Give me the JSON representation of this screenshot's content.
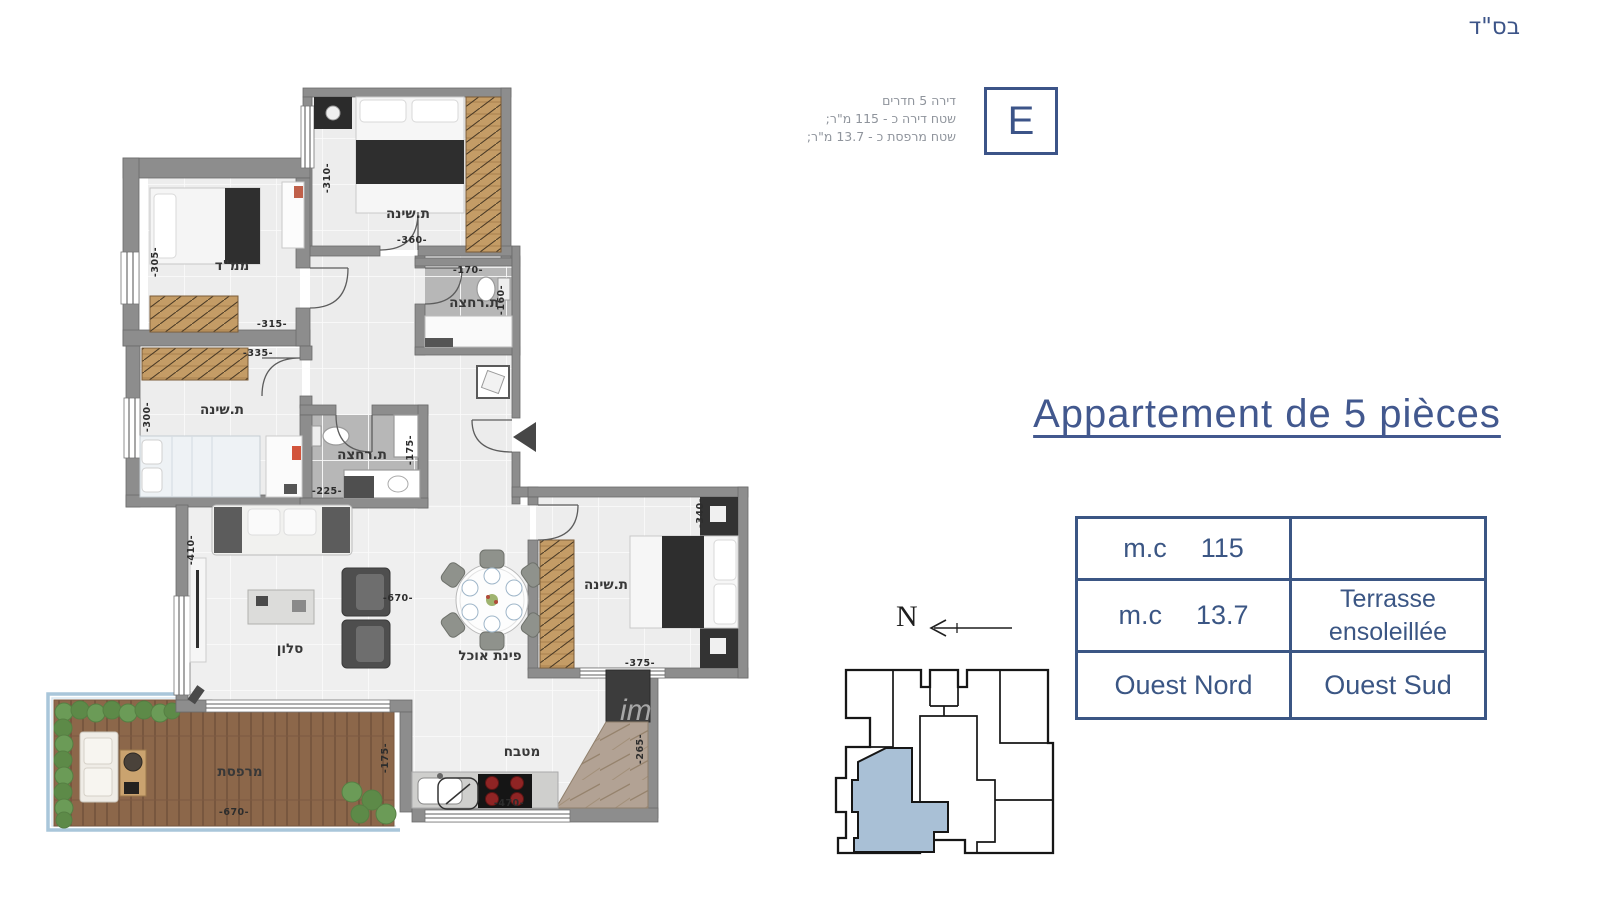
{
  "header": {
    "bsd": "בס\"ד"
  },
  "unit_info": {
    "letter": "E",
    "line1": "דירה 5 חדרים",
    "line2": "שטח דירה כ - 115 מ\"ר;",
    "line3": "שטח מרפסת כ - 13.7 מ\"ר;"
  },
  "title": "Appartement de 5 pièces",
  "spec_table": {
    "rows": [
      {
        "label": "m.c",
        "value": "115",
        "right": ""
      },
      {
        "label": "m.c",
        "value": "13.7",
        "right": "Terrasse\nensoleillée"
      },
      {
        "label": "",
        "value": "Ouest Nord",
        "right": "Ouest Sud"
      }
    ]
  },
  "compass": {
    "label": "N"
  },
  "watermark": "im",
  "colors": {
    "accent_blue": "#3c5488",
    "keyplan_unit_fill": "#a9c0d6"
  },
  "floor_plan": {
    "rooms": [
      {
        "label": "ת.שינה",
        "x": 408,
        "y": 218
      },
      {
        "label": "ממ\"ד",
        "x": 232,
        "y": 270
      },
      {
        "label": "ת.רחצה",
        "x": 474,
        "y": 307
      },
      {
        "label": "ת.שינה",
        "x": 222,
        "y": 414
      },
      {
        "label": "ת.רחצה",
        "x": 362,
        "y": 459
      },
      {
        "label": "סלון",
        "x": 290,
        "y": 653
      },
      {
        "label": "פינת אוכל",
        "x": 490,
        "y": 660
      },
      {
        "label": "ת.שינה",
        "x": 606,
        "y": 589
      },
      {
        "label": "מטבח",
        "x": 522,
        "y": 756
      },
      {
        "label": "מרפסת",
        "x": 240,
        "y": 776
      }
    ],
    "dims": [
      {
        "text": "-310-",
        "x": 330,
        "y": 178,
        "vertical": true
      },
      {
        "text": "-360-",
        "x": 412,
        "y": 243,
        "vertical": false
      },
      {
        "text": "-305-",
        "x": 158,
        "y": 262,
        "vertical": true
      },
      {
        "text": "-315-",
        "x": 272,
        "y": 327,
        "vertical": false
      },
      {
        "text": "-335-",
        "x": 258,
        "y": 356,
        "vertical": false
      },
      {
        "text": "-300-",
        "x": 150,
        "y": 417,
        "vertical": true
      },
      {
        "text": "-170-",
        "x": 468,
        "y": 273,
        "vertical": false
      },
      {
        "text": "-160-",
        "x": 504,
        "y": 300,
        "vertical": true
      },
      {
        "text": "-225-",
        "x": 327,
        "y": 494,
        "vertical": false
      },
      {
        "text": "-175-",
        "x": 413,
        "y": 450,
        "vertical": true
      },
      {
        "text": "-410-",
        "x": 194,
        "y": 550,
        "vertical": true
      },
      {
        "text": "-670-",
        "x": 398,
        "y": 601,
        "vertical": false
      },
      {
        "text": "-340-",
        "x": 703,
        "y": 513,
        "vertical": true
      },
      {
        "text": "-375-",
        "x": 640,
        "y": 666,
        "vertical": false
      },
      {
        "text": "-470-",
        "x": 509,
        "y": 806,
        "vertical": false
      },
      {
        "text": "-265-",
        "x": 643,
        "y": 749,
        "vertical": true
      },
      {
        "text": "-670-",
        "x": 234,
        "y": 815,
        "vertical": false
      },
      {
        "text": "-175-",
        "x": 388,
        "y": 758,
        "vertical": true
      }
    ]
  }
}
